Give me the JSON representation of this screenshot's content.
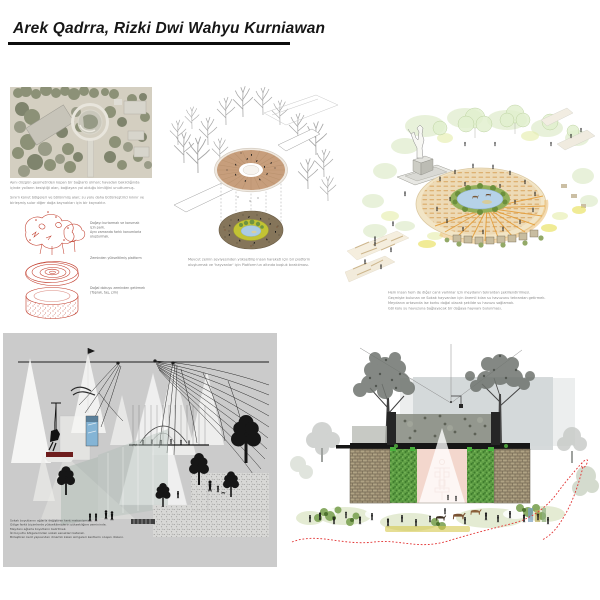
{
  "header": {
    "title": "Arek Qadrra, Rizki Dwi Wahyu Kurniawan"
  },
  "site_panel": {
    "caption1": [
      "Aynı düzgün geometriden kopan bir bağlantı olmalı; havadan bakıldığında",
      "içinde yolların kesiştiği alan, bağlayan yol olduğu kimliğini unutturmuş."
    ],
    "caption2": [
      "Sınırlı konut bölgeleri ve bölünmüş alan; su yolu daha bütünleştirici kılınır ve",
      "birleşmiş sular diğer doğa kaynakları için bir kaynaktır."
    ],
    "sketch_labels": {
      "trees": [
        "Doğayı kurtarmak ve korumak",
        "için park.",
        "Aynı zamanda farklı konumlarla",
        "oluşturmak."
      ],
      "platform": [
        "Zeminden yükseltilmiş platform"
      ],
      "ground": [
        "Doğal dokuyu zeminden getirmek",
        "(Toprak, taş, çim)"
      ]
    }
  },
  "axon_panel": {
    "caption": [
      "Mevcut zemin seviyesinden yükseltilip insan hareketi için bir platform",
      "oluşturmak ve 'hayvanlar' için Platform'un altında boşluk bırakılması."
    ]
  },
  "perspective_panel": {
    "caption": [
      "Hem insan hem de diğer canlı varlıklar için meydanın tekrardan şekillendirilmesi.",
      "Geçmişte bulunan ve Sokak hayvanları için önemli kılan su havuzunu tekrardan getirmek.",
      "Meydanın ortasında ise korku doğal olacak şekilde su havuzu sağlamak.",
      "Göl kolu su havuzuna bağlayacak bir doğaya hayvanı bulunması."
    ]
  },
  "collage_panel": {
    "caption": [
      "Sokak boyutlarını ağlarla değiştiren kent mekanizması.",
      "Gölge farklı biçimlerde yükseltilmişlerin yüksekliğine zemininde.",
      "Meydanı ağlarla boyutların belirtmek.",
      "İki boyutlu bölgelerinden sokak esnekleri katarak.",
      "Birleştiren kent yapısından dinamik kalan simgeleri kentlerin oluşan düzeni."
    ]
  },
  "colors": {
    "sketch_red": "#c13b2a",
    "deck_tan": "#c79e7c",
    "soil_brown": "#85755a",
    "meadow_yellow": "#c2c334",
    "pond_blue": "#abcbe3",
    "panel_gray": "#cbcbcb",
    "stitch_red": "#e23333"
  }
}
